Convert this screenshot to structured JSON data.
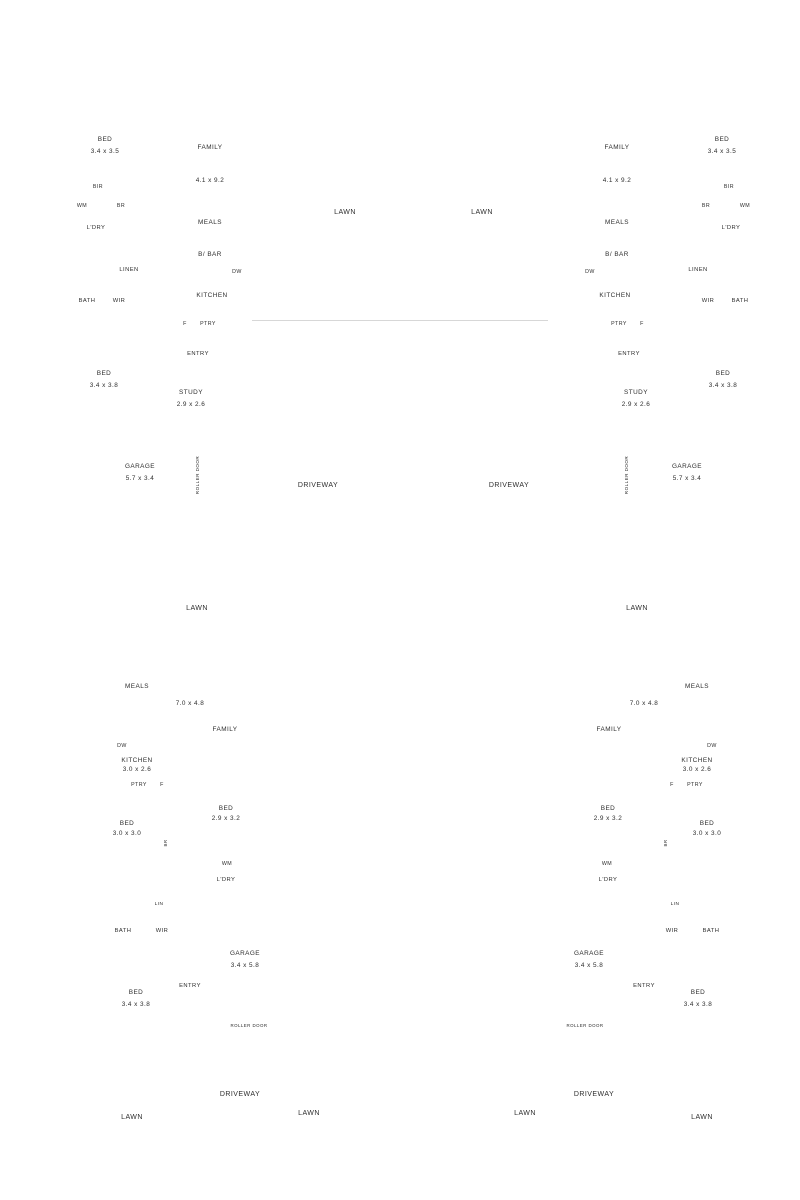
{
  "page": {
    "background": "#ffffff",
    "wall_color": "#0b0b0b",
    "boundary_color": "#9a9a9a",
    "text_color": "#2e2e2e",
    "seam_color": "#d7d7d7"
  },
  "instances": [
    {
      "id": "tl",
      "template": "top",
      "mirror": false,
      "name": "floor-plan-top-left"
    },
    {
      "id": "tr",
      "template": "top",
      "mirror": true,
      "name": "floor-plan-top-right"
    },
    {
      "id": "bl",
      "template": "bottom",
      "mirror": false,
      "name": "floor-plan-bottom-left"
    },
    {
      "id": "br",
      "template": "bottom",
      "mirror": true,
      "name": "floor-plan-bottom-right"
    }
  ],
  "plans": {
    "top": {
      "width": 360,
      "height": 477,
      "labels": [
        {
          "t": "BED",
          "x": 64,
          "y": 77
        },
        {
          "t": "3.4 x 3.5",
          "x": 64,
          "y": 89
        },
        {
          "t": "FAMILY",
          "x": 169,
          "y": 85
        },
        {
          "t": "4.1 x 9.2",
          "x": 169,
          "y": 118
        },
        {
          "t": "MEALS",
          "x": 169,
          "y": 160
        },
        {
          "t": "B/ BAR",
          "x": 169,
          "y": 192
        },
        {
          "t": "DW",
          "x": 196,
          "y": 209,
          "fs": 5.3
        },
        {
          "t": "KITCHEN",
          "x": 171,
          "y": 233
        },
        {
          "t": "F",
          "x": 144,
          "y": 261,
          "fs": 5.3
        },
        {
          "t": "PTRY",
          "x": 167,
          "y": 261,
          "fs": 5.3
        },
        {
          "t": "BIR",
          "x": 57,
          "y": 124,
          "fs": 5.3
        },
        {
          "t": "WM",
          "x": 41,
          "y": 143,
          "fs": 5.3
        },
        {
          "t": "BR",
          "x": 80,
          "y": 143,
          "fs": 5.3
        },
        {
          "t": "L'DRY",
          "x": 55,
          "y": 165,
          "fs": 5.8
        },
        {
          "t": "LINEN",
          "x": 88,
          "y": 207,
          "fs": 5.8
        },
        {
          "t": "BATH",
          "x": 46,
          "y": 238,
          "fs": 5.8
        },
        {
          "t": "WIR",
          "x": 78,
          "y": 238,
          "fs": 5.8
        },
        {
          "t": "BED",
          "x": 63,
          "y": 311
        },
        {
          "t": "3.4 x 3.8",
          "x": 63,
          "y": 323
        },
        {
          "t": "ENTRY",
          "x": 157,
          "y": 291,
          "fs": 5.8
        },
        {
          "t": "STUDY",
          "x": 150,
          "y": 330
        },
        {
          "t": "2.9 x 2.6",
          "x": 150,
          "y": 342
        },
        {
          "t": "GARAGE",
          "x": 99,
          "y": 404
        },
        {
          "t": "5.7 x 3.4",
          "x": 99,
          "y": 416
        },
        {
          "t": "ROLLER DOOR",
          "x": 158,
          "y": 411,
          "r": -90,
          "fs": 4.6
        },
        {
          "t": "LAWN",
          "x": 304,
          "y": 150,
          "fs": 7
        },
        {
          "t": "DRIVEWAY",
          "x": 277,
          "y": 423,
          "fs": 7
        }
      ]
    },
    "bottom": {
      "width": 275,
      "height": 580,
      "labels": [
        {
          "t": "LAWN",
          "x": 129,
          "y": 36,
          "fs": 7
        },
        {
          "t": "MEALS",
          "x": 69,
          "y": 114
        },
        {
          "t": "7.0 x 4.8",
          "x": 122,
          "y": 131
        },
        {
          "t": "FAMILY",
          "x": 157,
          "y": 157
        },
        {
          "t": "DW",
          "x": 54,
          "y": 173,
          "fs": 5.3
        },
        {
          "t": "KITCHEN",
          "x": 69,
          "y": 188
        },
        {
          "t": "3.0 x 2.6",
          "x": 69,
          "y": 197
        },
        {
          "t": "PTRY",
          "x": 71,
          "y": 212,
          "fs": 5.3
        },
        {
          "t": "F",
          "x": 94,
          "y": 212,
          "fs": 5.3
        },
        {
          "t": "BED",
          "x": 158,
          "y": 236
        },
        {
          "t": "2.9 x 3.2",
          "x": 158,
          "y": 246
        },
        {
          "t": "BED",
          "x": 59,
          "y": 251
        },
        {
          "t": "3.0 x 3.0",
          "x": 59,
          "y": 261
        },
        {
          "t": "BR",
          "x": 99,
          "y": 269,
          "r": -90,
          "fs": 4.4
        },
        {
          "t": "WM",
          "x": 159,
          "y": 291,
          "fs": 5.3
        },
        {
          "t": "L'DRY",
          "x": 158,
          "y": 307,
          "fs": 5.8
        },
        {
          "t": "LIN",
          "x": 91,
          "y": 331,
          "fs": 4.8
        },
        {
          "t": "BATH",
          "x": 55,
          "y": 358,
          "fs": 5.8
        },
        {
          "t": "WIR",
          "x": 94,
          "y": 358,
          "fs": 5.8
        },
        {
          "t": "GARAGE",
          "x": 177,
          "y": 381
        },
        {
          "t": "3.4 x 5.8",
          "x": 177,
          "y": 393
        },
        {
          "t": "ENTRY",
          "x": 122,
          "y": 413,
          "fs": 5.8
        },
        {
          "t": "BED",
          "x": 68,
          "y": 420
        },
        {
          "t": "3.4 x 3.8",
          "x": 68,
          "y": 432
        },
        {
          "t": "ROLLER DOOR",
          "x": 181,
          "y": 453,
          "fs": 4.4
        },
        {
          "t": "DRIVEWAY",
          "x": 172,
          "y": 522,
          "fs": 7
        },
        {
          "t": "LAWN",
          "x": 64,
          "y": 545,
          "fs": 7
        },
        {
          "t": "LAWN",
          "x": 241,
          "y": 541,
          "fs": 7
        }
      ]
    }
  }
}
